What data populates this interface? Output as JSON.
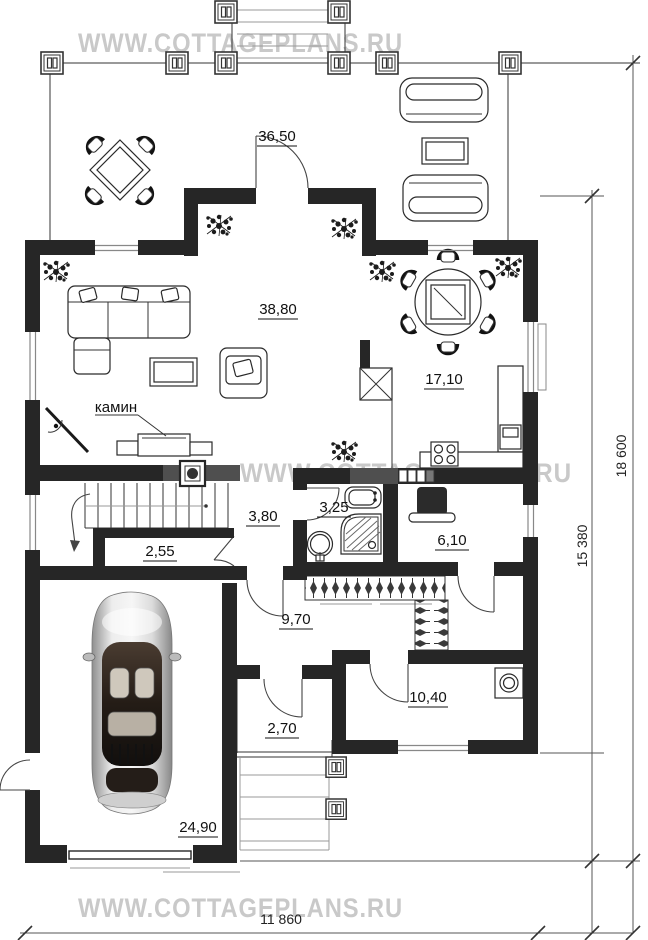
{
  "watermark": {
    "text": "WWW.COTTAGEPLANS.RU"
  },
  "rooms": {
    "terrace": "36,50",
    "living_room": "38,80",
    "kitchen_dining": "17,10",
    "stair_hall": "3,80",
    "under_stairs_closet": "2,55",
    "bathroom": "3,25",
    "boiler_room": "6,10",
    "hallway": "9,70",
    "utility_room": "10,40",
    "entry_porch": "2,70",
    "garage": "24,90"
  },
  "annotations": {
    "fireplace_label": "камин"
  },
  "dimensions": {
    "overall_depth": "18 600",
    "house_depth": "15 380",
    "house_width": "11 860"
  },
  "colors": {
    "wall": "#262626",
    "wall_accent": "#4f4f4f",
    "watermark": "#c9c9c9",
    "line": "#333333"
  }
}
